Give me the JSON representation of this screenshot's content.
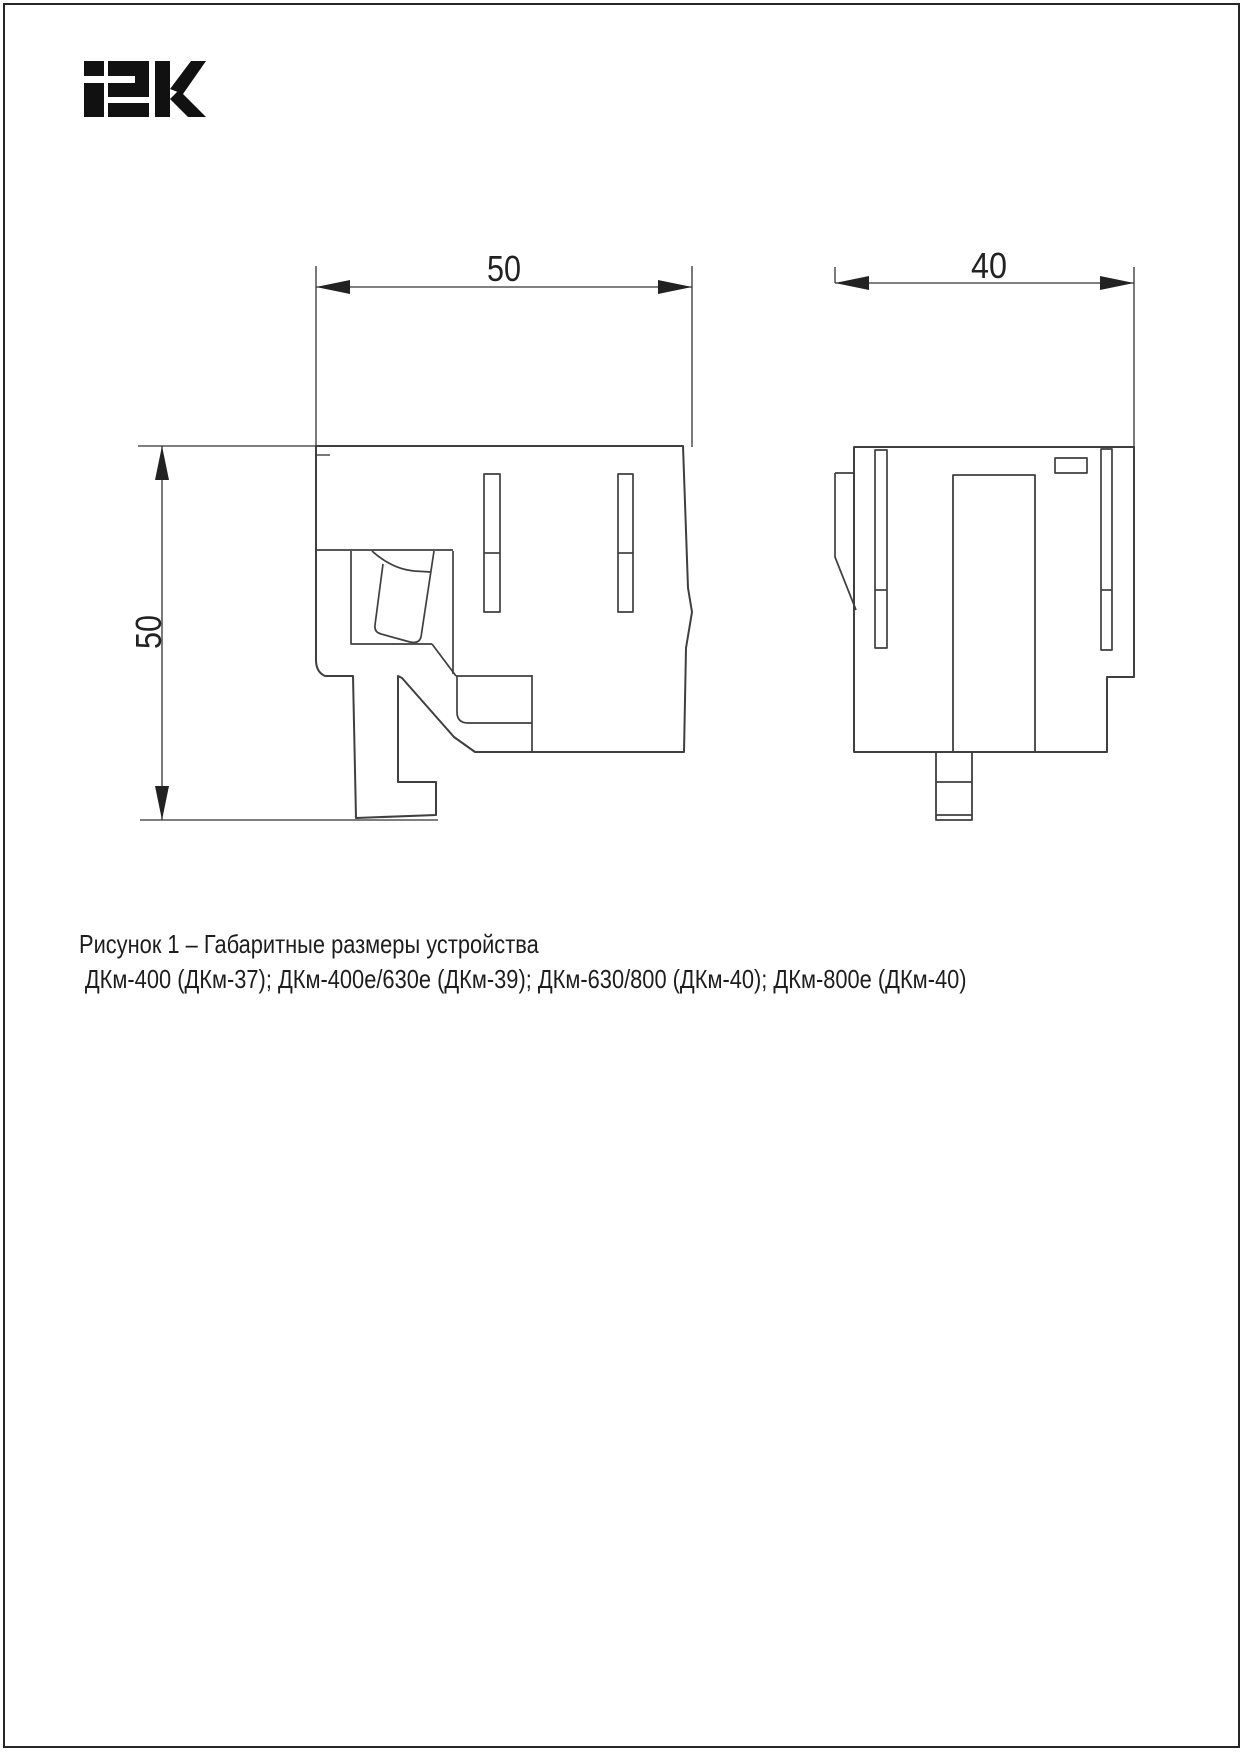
{
  "logo": {
    "text": "IEK",
    "color": "#111111"
  },
  "dimensions": {
    "side_width": "50",
    "side_height": "50",
    "front_width": "40"
  },
  "caption": {
    "line1": "Рисунок 1 – Габаритные размеры устройства",
    "line2": "ДКм-400 (ДКм-37); ДКм-400е/630е (ДКм-39); ДКм-630/800 (ДКм-40); ДКм-800е (ДКм-40)"
  },
  "colors": {
    "outline": "#3f3f3f",
    "dimension": "#333333",
    "border": "#262626"
  }
}
